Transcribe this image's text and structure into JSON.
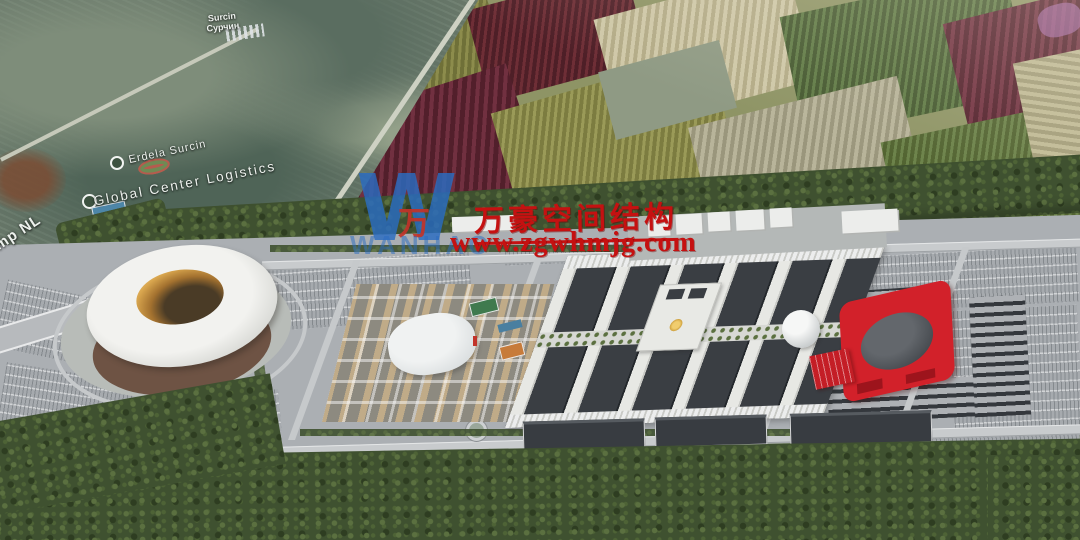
{
  "watermark": {
    "logo_letter": "W",
    "logo_mark": "万",
    "logo_name": "WANHAO",
    "company_cn": "万豪空间结构",
    "website": "www.zgwhmjg.com"
  },
  "map_labels": {
    "town": "Surcin",
    "town_alt": "Сурчин",
    "district": "Erdela Surcin",
    "logistics": "Global Center Logistics",
    "road": "mp NL"
  },
  "colors": {
    "accent-red": "#c51111",
    "logo-blue": "#2a6cc2",
    "building-red": "#d2212a",
    "stadium-gold": "#d9a64e",
    "forest": "#3f5130",
    "ground": "#abafb3",
    "roof-dark": "#383c41"
  }
}
